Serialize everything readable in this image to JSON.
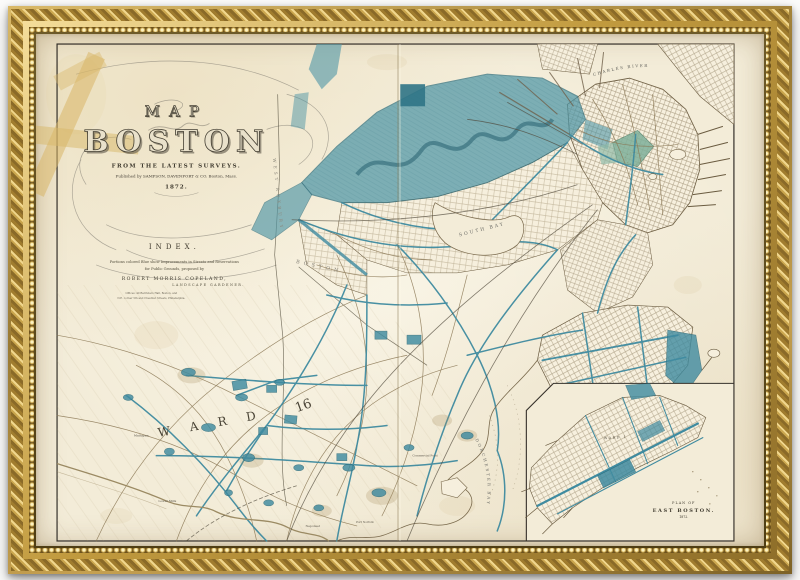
{
  "title_block": {
    "map_word": "MAP",
    "city": "BOSTON",
    "subtitle": "FROM THE LATEST SURVEYS.",
    "imprint": "Published by SAMPSON, DAVENPORT & CO. Boston, Mass.",
    "year": "1872."
  },
  "index_block": {
    "heading": "INDEX.",
    "line1": "Portions colored Blue show Improvements in Streets and Reservations",
    "line2": "for Public Grounds, proposed by",
    "author": "ROBERT MORRIS COPELAND,",
    "author_title": "LANDSCAPE GARDENER.",
    "office_line1": "Offices: 40 Barristers Hall, Boston, and",
    "office_line2": "N.E. corner 5th and Chestnut Streets, Philadelphia."
  },
  "map_labels": {
    "charles_river": "CHARLES RIVER",
    "south_bay": "SOUTH BAY",
    "west_roxbury": "WEST ROXBURY",
    "boston_boundary": "BOSTON",
    "ward_word": "W A R D",
    "ward_number": "16",
    "dorchester_bay": "DORCHESTER BAY",
    "mattapan": "Mattapan",
    "lower_mills": "Lower Mills",
    "neponset": "Neponset",
    "port_norfolk": "Port Norfolk",
    "commercial_point": "Commercial Point"
  },
  "inset": {
    "plan_of": "PLAN OF",
    "east_boston": "EAST BOSTON.",
    "year": "1872.",
    "ward1": "WARD 1"
  },
  "colors": {
    "improvement_blue": "#42869b",
    "paper_cream": "#f3ecd8",
    "frame_gold": "#c9a64f",
    "neatline_ink": "#35302a"
  }
}
